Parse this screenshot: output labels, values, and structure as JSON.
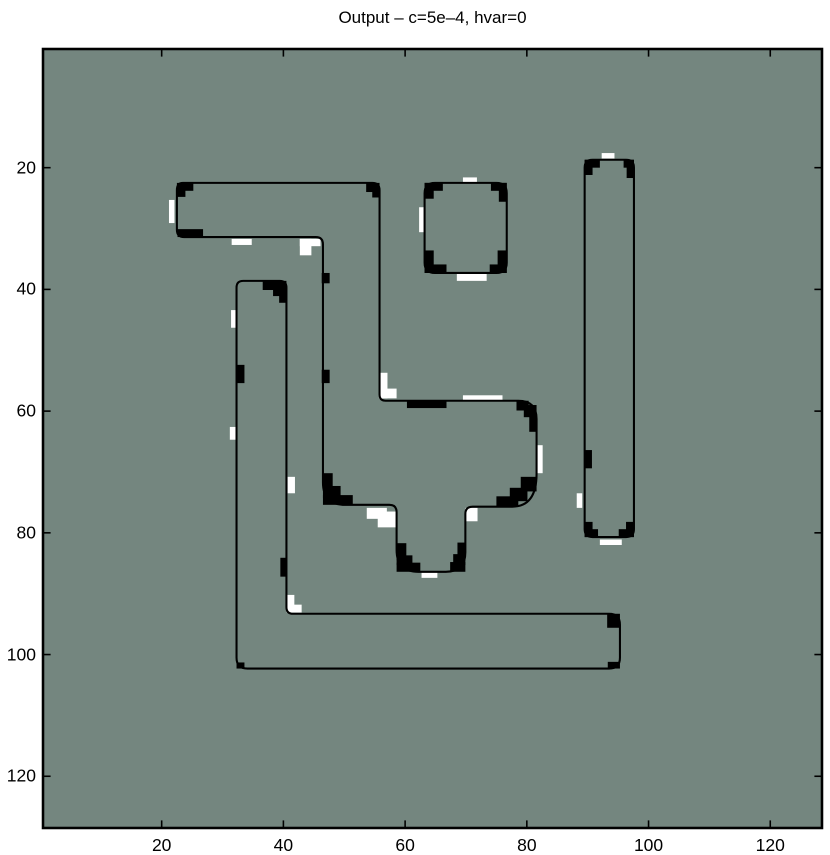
{
  "chart_data": {
    "type": "heatmap",
    "title": "Output – c=5e–4, hvar=0",
    "xlabel": "",
    "ylabel": "",
    "xlim": [
      0.5,
      128.5
    ],
    "ylim": [
      0.5,
      128.5
    ],
    "y_axis_direction": "reverse",
    "x_ticks": [
      20,
      40,
      60,
      80,
      100,
      120
    ],
    "y_ticks": [
      20,
      40,
      60,
      80,
      100,
      120
    ],
    "grid": "off",
    "legend": "none",
    "background_color": "#74867f",
    "contour_color": "#000000",
    "highlight_color": "#ffffff",
    "description": "Level-set segmentation output: uniform mid-gray field with thin black contour outlines of shapes, thick black pixel clusters on corners/edges and white pixel clusters adjacent to contours",
    "shapes": [
      {
        "name": "bar-blob-tail",
        "outline": "M 23.5 22.5 H 54.6 Q 55.8 22.5 55.8 23.7 V 57.3 Q 55.8 58.3 56.8 58.3 H 78.6 Q 81.6 58.3 81.6 61.3 V 70.3 Q 81.6 75.7 77.6 75.7 H 71.1 Q 69.9 75.7 69.9 76.9 V 83.2 Q 69.9 86.4 66.7 86.4 H 62.2 Q 58.6 86.4 58.6 82.8 V 76.6 Q 58.6 75.4 57.4 75.4 H 50.2 Q 46.5 75.4 46.5 71.7 V 32.6 Q 46.5 31.4 45.3 31.4 H 23.7 Q 22.5 31.4 22.5 30.2 V 23.7 Q 22.5 22.5 23.5 22.5 Z"
      },
      {
        "name": "rounded-square",
        "outline": "M 64.9 22.5 H 75.0 Q 76.7 22.5 76.7 24.2 V 35.6 Q 76.7 37.3 75.0 37.3 H 64.9 Q 63.2 37.3 63.2 35.6 V 24.2 Q 63.2 22.5 64.9 22.5 Z"
      },
      {
        "name": "tall-rectangle",
        "outline": "M 90.8 18.7 H 96.3 Q 97.6 18.7 97.6 20.0 V 79.4 Q 97.6 80.7 96.3 80.7 H 90.8 Q 89.5 80.7 89.5 79.4 V 20.0 Q 89.5 18.7 90.8 18.7 Z"
      },
      {
        "name": "l-shape",
        "outline": "M 33.4 38.6 H 39.4 Q 40.5 38.6 40.5 39.7 V 92.2 Q 40.5 93.3 41.6 93.3 H 93.5 Q 95.3 93.3 95.3 95.1 V 100.5 Q 95.3 102.3 93.5 102.3 H 34.1 Q 32.3 102.3 32.3 100.5 V 39.7 Q 32.3 38.6 33.4 38.6 Z"
      }
    ],
    "black_marks": [
      [
        22.5,
        22.5,
        2.7,
        1.3
      ],
      [
        22.5,
        23.3,
        1.4,
        1.5
      ],
      [
        53.6,
        22.5,
        2.2,
        1.5
      ],
      [
        54.6,
        23.6,
        1.2,
        1.3
      ],
      [
        22.6,
        30.1,
        4.2,
        1.3
      ],
      [
        46.3,
        37.3,
        1.3,
        1.7
      ],
      [
        46.3,
        53.2,
        1.3,
        2.2
      ],
      [
        60.3,
        58.3,
        6.5,
        1.2
      ],
      [
        78.3,
        58.3,
        2.0,
        1.6
      ],
      [
        79.5,
        59.0,
        2.1,
        2.0
      ],
      [
        80.4,
        60.4,
        1.2,
        3.0
      ],
      [
        79.0,
        70.8,
        2.6,
        2.4
      ],
      [
        77.2,
        72.6,
        2.9,
        2.2
      ],
      [
        75.0,
        74.0,
        3.6,
        1.7
      ],
      [
        46.5,
        70.2,
        1.6,
        2.7
      ],
      [
        46.5,
        72.3,
        2.9,
        2.0
      ],
      [
        46.5,
        73.8,
        4.9,
        1.6
      ],
      [
        58.6,
        81.7,
        1.6,
        2.8
      ],
      [
        58.6,
        83.7,
        2.6,
        1.6
      ],
      [
        58.6,
        84.9,
        3.9,
        1.5
      ],
      [
        68.6,
        81.6,
        1.3,
        2.7
      ],
      [
        67.9,
        83.5,
        2.0,
        1.8
      ],
      [
        67.4,
        84.8,
        2.5,
        1.6
      ],
      [
        63.2,
        22.5,
        3.0,
        1.3
      ],
      [
        63.2,
        22.5,
        1.5,
        2.6
      ],
      [
        74.1,
        22.5,
        2.6,
        1.3
      ],
      [
        75.4,
        22.5,
        1.3,
        3.1
      ],
      [
        63.2,
        33.6,
        1.5,
        3.7
      ],
      [
        63.2,
        35.9,
        3.6,
        1.4
      ],
      [
        75.2,
        33.6,
        1.5,
        3.7
      ],
      [
        73.9,
        35.9,
        2.8,
        1.4
      ],
      [
        89.5,
        18.7,
        2.5,
        1.3
      ],
      [
        89.5,
        18.7,
        1.3,
        2.5
      ],
      [
        95.9,
        18.7,
        1.7,
        1.3
      ],
      [
        96.4,
        18.7,
        1.2,
        3.0
      ],
      [
        89.5,
        66.4,
        1.2,
        3.0
      ],
      [
        89.5,
        78.2,
        1.3,
        2.5
      ],
      [
        89.5,
        79.4,
        2.2,
        1.3
      ],
      [
        96.3,
        78.2,
        1.3,
        2.5
      ],
      [
        95.1,
        79.4,
        2.5,
        1.3
      ],
      [
        36.6,
        38.6,
        3.9,
        1.5
      ],
      [
        38.3,
        39.6,
        2.2,
        1.5
      ],
      [
        39.3,
        40.7,
        1.2,
        1.5
      ],
      [
        32.3,
        52.4,
        1.3,
        3.0
      ],
      [
        39.5,
        84.1,
        1.0,
        3.1
      ],
      [
        32.3,
        101.3,
        1.3,
        1.0
      ],
      [
        93.2,
        93.3,
        2.1,
        2.3
      ],
      [
        93.3,
        101.2,
        2.0,
        1.1
      ]
    ],
    "white_marks": [
      [
        21.2,
        25.3,
        0.9,
        3.8
      ],
      [
        31.5,
        31.7,
        3.3,
        1.0
      ],
      [
        42.7,
        31.7,
        3.4,
        1.2
      ],
      [
        42.7,
        31.7,
        1.9,
        2.7
      ],
      [
        55.7,
        53.7,
        1.4,
        4.2
      ],
      [
        55.7,
        56.3,
        2.9,
        1.6
      ],
      [
        69.5,
        57.4,
        6.5,
        0.9
      ],
      [
        81.7,
        65.6,
        0.9,
        4.6
      ],
      [
        53.7,
        75.9,
        3.3,
        1.8
      ],
      [
        55.5,
        76.5,
        3.1,
        2.6
      ],
      [
        69.9,
        75.9,
        2.0,
        2.2
      ],
      [
        62.7,
        86.5,
        2.6,
        0.9
      ],
      [
        69.5,
        21.6,
        2.3,
        0.9
      ],
      [
        62.3,
        26.5,
        0.9,
        4.1
      ],
      [
        68.5,
        37.4,
        4.9,
        1.2
      ],
      [
        92.3,
        17.6,
        2.1,
        0.9
      ],
      [
        88.2,
        73.5,
        0.9,
        2.4
      ],
      [
        92.0,
        81.1,
        3.6,
        0.9
      ],
      [
        31.4,
        43.4,
        0.9,
        2.9
      ],
      [
        31.2,
        62.6,
        1.1,
        2.1
      ],
      [
        40.7,
        70.8,
        1.2,
        2.7
      ],
      [
        40.5,
        90.2,
        1.3,
        2.8
      ],
      [
        40.5,
        91.8,
        2.5,
        1.3
      ]
    ]
  },
  "layout_px": {
    "plot_left": 43,
    "plot_top": 49,
    "plot_size": 779
  }
}
